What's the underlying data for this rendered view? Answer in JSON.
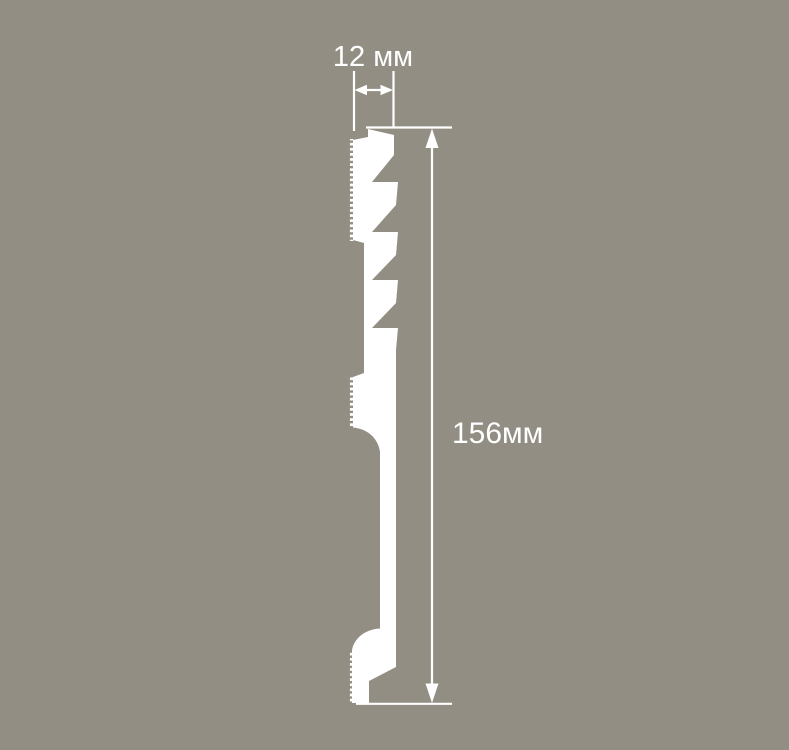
{
  "colors": {
    "background": "#928e84",
    "profile": "#ffffff",
    "line": "#ffffff",
    "text": "#ffffff"
  },
  "figure": {
    "name": "skirting-profile-cross-section"
  },
  "dimensions": {
    "width": {
      "label": "12 мм",
      "value": "12",
      "unit": "мм",
      "orientation": "horizontal"
    },
    "height": {
      "label": "156мм",
      "value": "156",
      "unit": "мм",
      "orientation": "vertical"
    }
  }
}
